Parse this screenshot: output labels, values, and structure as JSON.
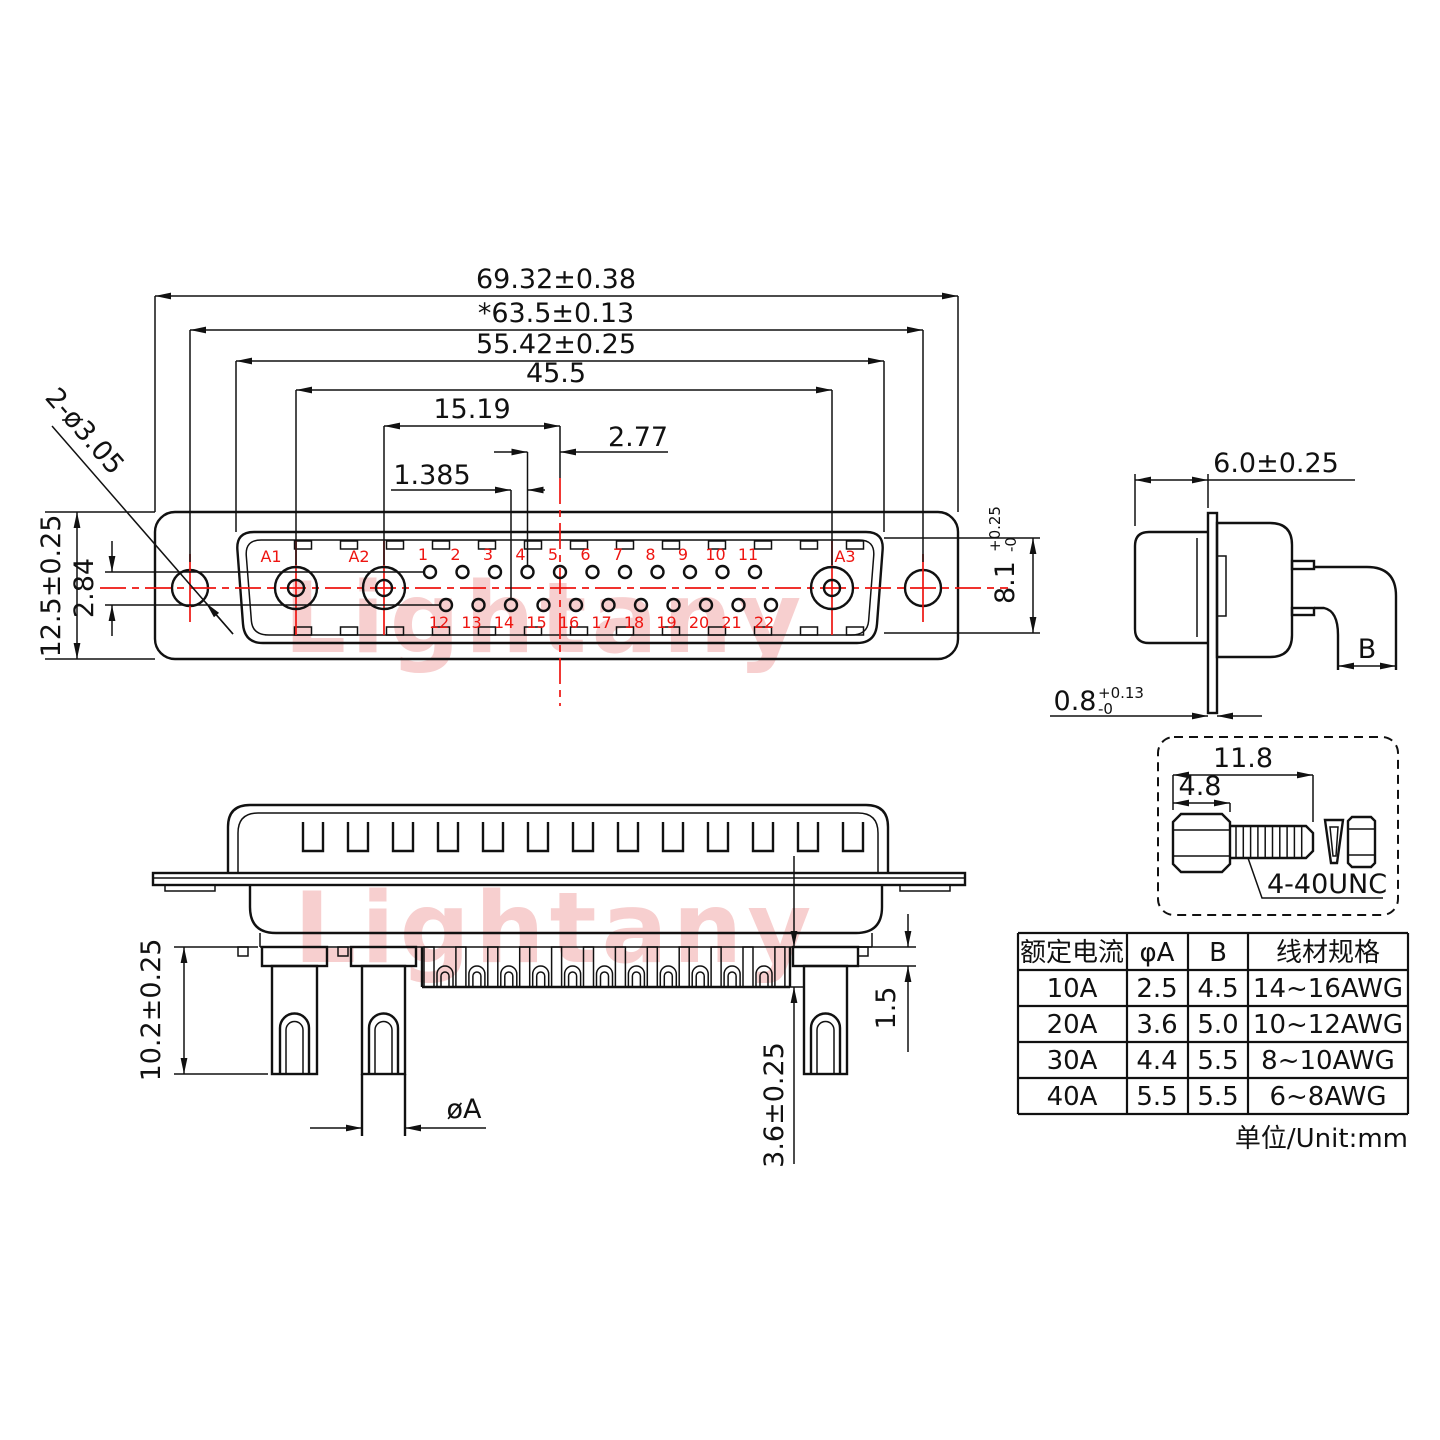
{
  "watermark": {
    "text": "Lightany"
  },
  "front_view": {
    "dims": {
      "overall_width": "69.32±0.38",
      "mount_spacing": "*63.5±0.13",
      "shell_width": "55.42±0.25",
      "power_span": "45.5",
      "a2_to_center": "15.19",
      "pitch": "2.77",
      "half_pitch": "1.385",
      "flange_height": "12.5±0.25",
      "row_spacing": "2.84",
      "mount_holes": "2-ø3.05",
      "opening_height": "8.1",
      "opening_tol_plus": "+0.25",
      "opening_tol_minus": "-0"
    },
    "pins": {
      "power": [
        "A1",
        "A2",
        "A3"
      ],
      "top": [
        "1",
        "2",
        "3",
        "4",
        "5",
        "6",
        "7",
        "8",
        "9",
        "10",
        "11"
      ],
      "bottom": [
        "12",
        "13",
        "14",
        "15",
        "16",
        "17",
        "18",
        "19",
        "20",
        "21",
        "22"
      ]
    }
  },
  "side_view": {
    "dims": {
      "depth": "6.0±0.25",
      "flange_thickness": "0.8",
      "flange_tol_plus": "+0.13",
      "flange_tol_minus": "-0",
      "wire_width": "B"
    }
  },
  "screw_detail": {
    "dims": {
      "total_length": "11.8",
      "head_length": "4.8"
    },
    "thread_label": "4-40UNC"
  },
  "rear_view": {
    "dims": {
      "power_pin_length": "10.2±0.25",
      "power_pin_dia": "øA",
      "signal_pin_length": "3.6±0.25",
      "shoulder_height": "1.5"
    }
  },
  "spec_table": {
    "headers": [
      "额定电流",
      "φA",
      "B",
      "线材规格"
    ],
    "rows": [
      [
        "10A",
        "2.5",
        "4.5",
        "14~16AWG"
      ],
      [
        "20A",
        "3.6",
        "5.0",
        "10~12AWG"
      ],
      [
        "30A",
        "4.4",
        "5.5",
        "8~10AWG"
      ],
      [
        "40A",
        "5.5",
        "5.5",
        "6~8AWG"
      ]
    ],
    "unit_note": "单位/Unit:mm"
  }
}
